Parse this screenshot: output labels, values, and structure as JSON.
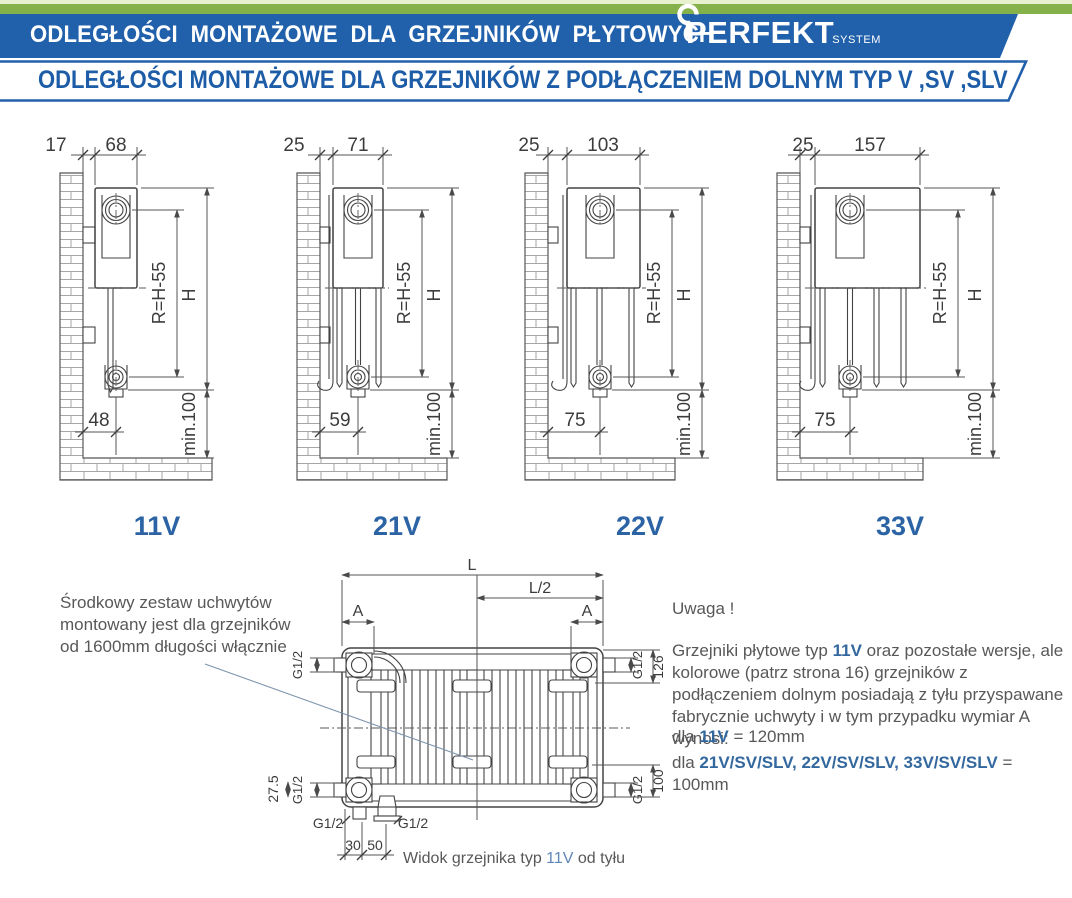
{
  "header": {
    "title": "ODLEGŁOŚCI MONTAŻOWE DLA GRZEJNIKÓW PŁYTOWYCH",
    "brand": "PERFEKT",
    "brand_sub": "SYSTEM",
    "subtitle": "ODLEGŁOŚCI MONTAŻOWE DLA GRZEJNIKÓW Z PODŁĄCZENIEM DOLNYM TYP V ,SV ,SLV"
  },
  "colors": {
    "band_green": "#84b14a",
    "band_green_pale": "#e7f1cd",
    "banner_blue": "#2160aa",
    "subtitle_blue": "#1d5ca6",
    "type_label_blue": "#2b63a4",
    "note_blue": "#33689f",
    "caption_blue": "#5e87b8",
    "body_text": "#58585a",
    "drawing_line": "#434343",
    "leader_line": "#7b93ab"
  },
  "dim_labels": {
    "h": "H",
    "r": "R=H-55",
    "min": "min.100"
  },
  "diagrams": [
    {
      "label": "11V",
      "gap": "17",
      "depth": "68",
      "bottom": "48"
    },
    {
      "label": "21V",
      "gap": "25",
      "depth": "71",
      "bottom": "59"
    },
    {
      "label": "22V",
      "gap": "25",
      "depth": "103",
      "bottom": "75"
    },
    {
      "label": "33V",
      "gap": "25",
      "depth": "157",
      "bottom": "75"
    }
  ],
  "back_view": {
    "L": "L",
    "L2": "L/2",
    "A": "A",
    "g12": "G1/2",
    "d126": "126",
    "d100": "100",
    "d27": "27.5",
    "d30": "30",
    "d50": "50",
    "caption_pre": "Widok grzejnika typ ",
    "caption_type": "11V",
    "caption_post": " od tyłu"
  },
  "notes": {
    "left_line1": "Środkowy zestaw uchwytów",
    "left_line2": "montowany jest dla grzejników",
    "left_line3": "od 1600mm długości włącznie",
    "uwaga": "Uwaga !",
    "p1a": "Grzejniki płytowe typ ",
    "p1b": "11V",
    "p1c": " oraz pozostałe wersje, ale kolorowe (patrz strona 16) grzejników z podłączeniem dolnym posiadają z tyłu przyspawane fabrycznie uchwyty i w tym przypadku wymiar A wynosi:",
    "d1a": "dla ",
    "d1b": "11V",
    "d1c": " = 120mm",
    "d2a": "dla ",
    "d2b": "21V/SV/SLV, 22V/SV/SLV, 33V/SV/SLV",
    "d2c": " = 100mm"
  }
}
